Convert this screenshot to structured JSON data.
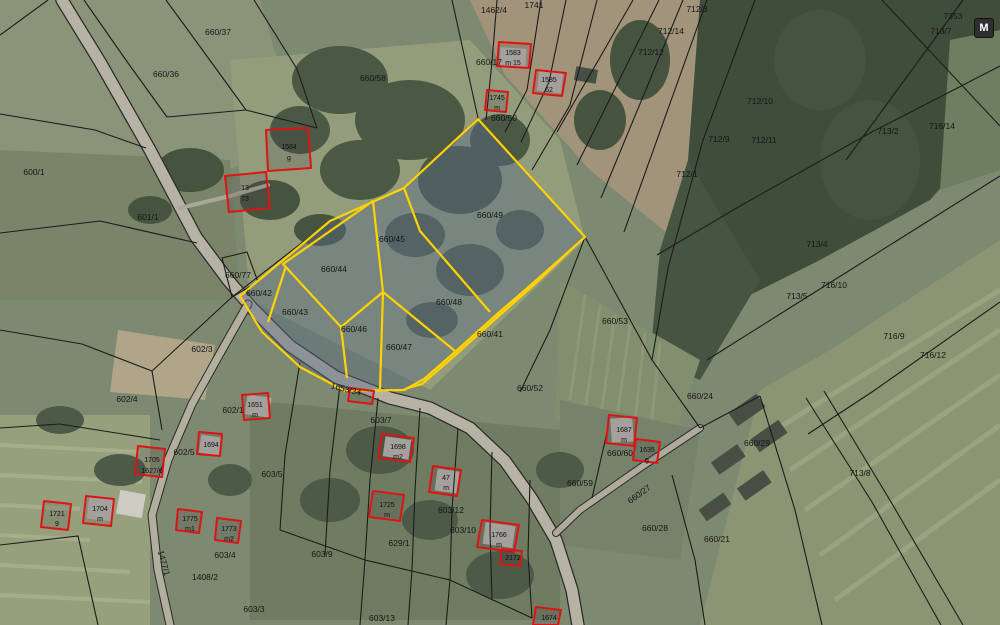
{
  "controls": {
    "m_button_label": "M"
  },
  "colors": {
    "selection_outline": "#ffd200",
    "selection_fill": "rgba(88,106,130,0.45)",
    "building_outline": "#dd1414",
    "boundary_line": "#1c1c1c",
    "road_fill": "#b6b2a4"
  },
  "parcels": [
    "660/37",
    "660/36",
    "600/1",
    "601/1",
    "1462/4",
    "1741",
    "660/17",
    "660/50",
    "660/58",
    "712/3",
    "712/14",
    "712/12",
    "712/10",
    "712/9",
    "712/11",
    "712/1",
    "7353",
    "713/7",
    "713/2",
    "716/14",
    "713/4",
    "716/10",
    "713/5",
    "716/9",
    "716/12",
    "660/49",
    "660/45",
    "660/44",
    "660/77",
    "660/42",
    "660/43",
    "660/46",
    "660/48",
    "660/47",
    "660/41",
    "660/53",
    "660/52",
    "1653/34",
    "602/3",
    "602/4",
    "602/1",
    "602/5",
    "603/5",
    "603/7",
    "603/12",
    "603/10",
    "629/1",
    "603/9",
    "603/4",
    "1477/1",
    "1408/2",
    "603/13",
    "603/3",
    "660/24",
    "660/29",
    "660/60",
    "660/59",
    "660/27",
    "660/28",
    "660/21",
    "713/8"
  ],
  "buildings": [
    {
      "l1": "1584",
      "l2": "g"
    },
    {
      "l1": "13",
      "l2": "73"
    },
    {
      "l1": "1583",
      "l2": "m 15"
    },
    {
      "l1": "1585",
      "l2": "62"
    },
    {
      "l1": "1745",
      "l2": "m"
    },
    {
      "l1": "1651",
      "l2": "m"
    },
    {
      "l1": "1694",
      "l2": ""
    },
    {
      "l1": "1705",
      "l2": "1627/6"
    },
    {
      "l1": "1704",
      "l2": "m"
    },
    {
      "l1": "1721",
      "l2": "9"
    },
    {
      "l1": "1775",
      "l2": "m1"
    },
    {
      "l1": "1773",
      "l2": "m2"
    },
    {
      "l1": "1698",
      "l2": "m2"
    },
    {
      "l1": "47",
      "l2": "m"
    },
    {
      "l1": "1725",
      "l2": "m"
    },
    {
      "l1": "1766",
      "l2": "m"
    },
    {
      "l1": "2172",
      "l2": ""
    },
    {
      "l1": "1674",
      "l2": ""
    },
    {
      "l1": "1687",
      "l2": "m"
    },
    {
      "l1": "1635",
      "l2": "g"
    }
  ]
}
